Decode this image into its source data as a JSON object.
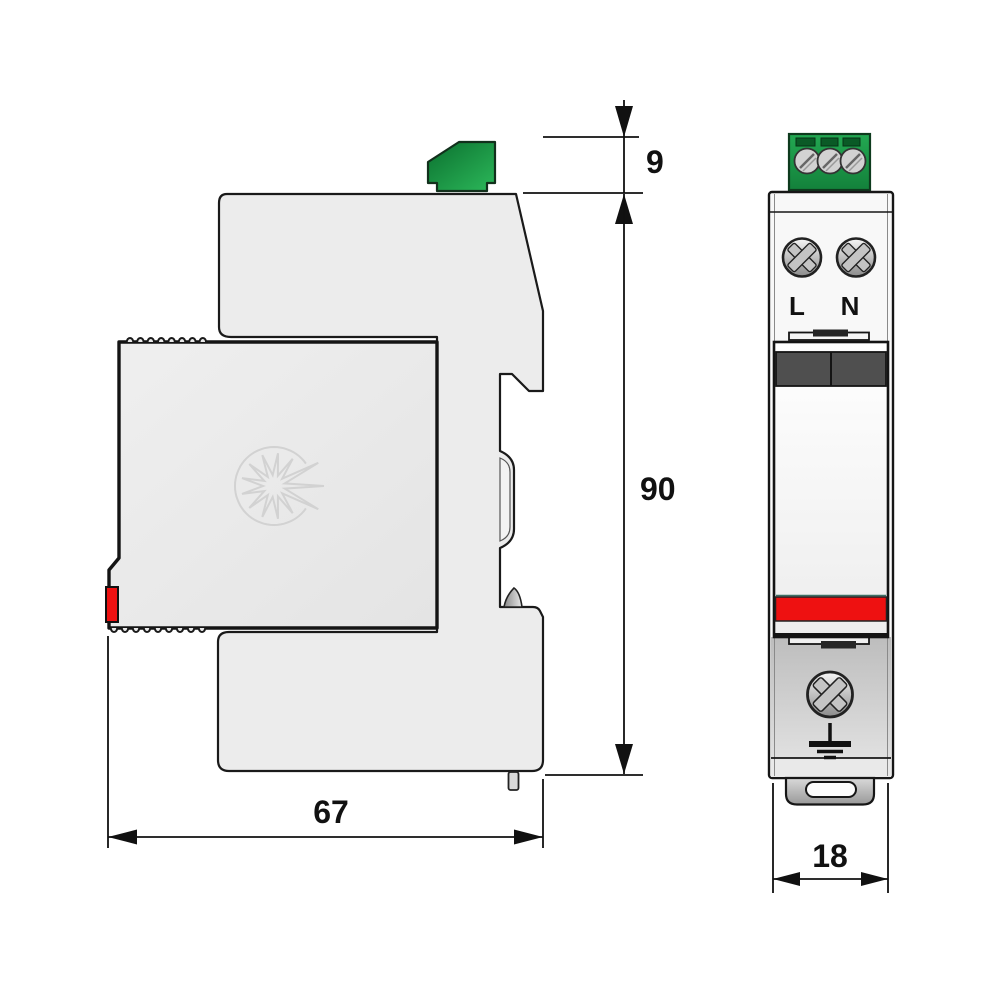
{
  "page": {
    "kind": "technical dimensional drawing",
    "subject": "DIN-rail surge protective device, side view and front view",
    "background": "#ffffff"
  },
  "dimensions": {
    "terminal_height": {
      "label": "9",
      "location": "height of top terminal block, side view"
    },
    "body_height": {
      "label": "90",
      "location": "overall body height, side view"
    },
    "body_depth": {
      "label": "67",
      "location": "overall depth, below side view"
    },
    "module_width": {
      "label": "18",
      "location": "module width, below front view"
    }
  },
  "front_view": {
    "terminal_left_label": "L",
    "terminal_right_label": "N"
  },
  "colors": {
    "connector_green": "#1d9e49",
    "indicator_red": "#ee1111",
    "band_dark_gray": "#4f4f4f",
    "body_light_gray": "#ececec",
    "outline": "#1a1a1a"
  }
}
